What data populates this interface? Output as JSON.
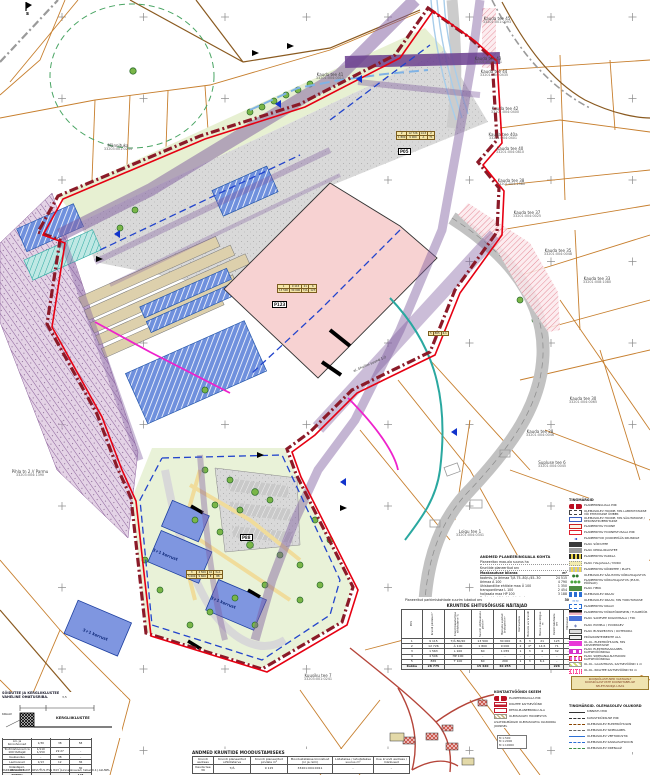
{
  "north_mark": "s",
  "colors": {
    "boundary_red": "#e60012",
    "boundary_dark": "#8b1a28",
    "plot_pink": "#f7d2d2",
    "building_blue": "#5b82d8",
    "corridor_purple": "#7d5a9e",
    "greenery": "#e9f2d8",
    "cadastral_orange": "#c77f2e"
  },
  "map": {
    "parcels": [
      {
        "name": "Kauda tee 45",
        "code": "33201:001:0093"
      },
      {
        "name": "Kauda tee 43",
        "code": "33201:001:0071"
      },
      {
        "name": "Kauda tee 44",
        "code": "33201:004:0435"
      },
      {
        "name": "Kauda tee 42",
        "code": "33201:004:0400"
      },
      {
        "name": "Kauda tee 40a",
        "code": "33201:004:0401"
      },
      {
        "name": "Kauda tee 40",
        "code": "33201:004:0810"
      },
      {
        "name": "Kauda tee 38",
        "code": "33201:004:1580"
      },
      {
        "name": "Kauda tee 37",
        "code": "33201:004:0025"
      },
      {
        "name": "Kauda tee 35",
        "code": "33201:004:0048"
      },
      {
        "name": "Kauda tee 33",
        "code": "33201:008:1080"
      },
      {
        "name": "Kauda tee 30",
        "code": "33201:004:0065"
      },
      {
        "name": "Kauda tee 28",
        "code": "33201:004:0046"
      },
      {
        "name": "Supluse tee 6",
        "code": "33201:004:0045"
      },
      {
        "name": "Pihla tn 2 // Parmu",
        "code": "33203:004:1390"
      },
      {
        "name": "Männituka",
        "code": "33203:001:0244"
      },
      {
        "name": "Kuusiku tee 7",
        "code": "33203:001:0241"
      },
      {
        "name": "Loigu tee 1",
        "code": "33201:004:0341"
      },
      {
        "name": "Kauda tee 41",
        "code": "33201:004:0011"
      }
    ],
    "building_labels": [
      "3+1 korrust",
      "3+1 korrust",
      "3+1 korrust"
    ],
    "pos_labels": [
      "P123",
      "P05",
      "P88"
    ],
    "line_label": "el. õhuliini suund 1:2",
    "mini_tables": {
      "t1": [
        [
          "1",
          "9 115",
          "21",
          "6"
        ],
        [
          "13 500",
          "30 000",
          "T/Ä",
          "123"
        ]
      ],
      "t2": [
        [
          "2",
          "12 726",
          "14,5",
          "2"
        ],
        [
          "1 800",
          "9 000",
          "Ä",
          "71"
        ]
      ],
      "t3": [
        [
          "3",
          "4 506",
          "10",
          "3+1"
        ],
        [
          "5 600",
          "9 600",
          "E",
          "88"
        ]
      ],
      "t4": [
        [
          "5",
          "865",
          "6,1"
        ]
      ]
    }
  },
  "summary": {
    "title": "ANDMED PLANEERINGUALA KOHTA",
    "rows": [
      {
        "label": "Planeeritav maa-ala suurus ha",
        "value": "3,2"
      },
      {
        "label": "Kruntide planeeritud arv",
        "value": "5"
      }
    ],
    "usage_header": {
      "label": "Maakasutuse bilanss",
      "col1": "m²",
      "col2": "%"
    },
    "usage_rows": [
      {
        "label": "tootmis- ja ärimaa T/Ä 75..80/–/45..30",
        "area": "24 515",
        "pct": "67"
      },
      {
        "label": "ärimaa Ä 100",
        "area": "4 790",
        "pct": "13"
      },
      {
        "label": "ühiskondlike ehitiste maa Ü 100",
        "area": "1 350",
        "pct": "4"
      },
      {
        "label": "transpordimaa L 100",
        "area": "2 454",
        "pct": "7"
      },
      {
        "label": "haljasala maa HP 100",
        "area": "3 188",
        "pct": "9"
      }
    ],
    "note": {
      "label": "Parkimiskohti kokku lubatud arv",
      "value": "30"
    }
  },
  "build_rights_table": {
    "note": {
      "label": "Planeeritud parkimiskohtade suurim lubatud arv",
      "value": "30"
    },
    "title": "KRUNTIDE EHITUSÕIGUSE NÄITAJAD",
    "columns": [
      "POS",
      "Krundi pindala m²",
      "Krundi kasutamise sihtotstarve %",
      "Suurim ehitisealune pind m²",
      "Hoonete suletud brutopind m²",
      "Korruselisus",
      "Hoonete arv krundil",
      "Hoone max kõrgus m",
      "Parkimiskohtade arv",
      "Märkused"
    ],
    "rows": [
      [
        "1",
        "9 115",
        "T/Ä 80/20",
        "13 500",
        "30 000",
        "6",
        "3",
        "21",
        "123",
        "–"
      ],
      [
        "2",
        "12 726",
        "Ä 100",
        "1 800",
        "9 000",
        "2",
        "4*",
        "14,5",
        "71",
        "–"
      ],
      [
        "3",
        "1 563",
        "L 100",
        "60",
        "1 055",
        "1",
        "3",
        "4",
        "32",
        "–"
      ],
      [
        "4",
        "4 506",
        "HP 100",
        "–",
        "–",
        "–",
        "–",
        "–",
        "–",
        "–"
      ],
      [
        "5",
        "865",
        "T 100",
        "60",
        "200",
        "1",
        "3",
        "6,1",
        "–",
        "–"
      ]
    ],
    "total": [
      "Kokku",
      "28 775",
      "",
      "15 420",
      "40 255",
      "",
      "",
      "",
      "226",
      ""
    ]
  },
  "parking_table": {
    "title": "PARKIMISKOHTADE ARVUTUS (EVS 843)",
    "columns": [
      "Kasutusotstarve",
      "parkimis- normatiiv",
      "arvutuslik kohtade arv",
      "planeeritud kohtade arv"
    ],
    "rows": [
      [
        "Äri- ja büroohooned",
        "1/30",
        "38",
        "58"
      ],
      [
        "Tootmishooned ca 100 töötajat",
        "1/110  1/150",
        "29  27",
        "–"
      ],
      [
        "Kaubandus",
        "–",
        "38",
        "–"
      ],
      [
        "Laohooned",
        "1/13",
        "12",
        "36"
      ],
      [
        "Külastajad, abiruumid",
        "–",
        "–",
        "30"
      ]
    ],
    "total": [
      "KOKKU",
      "",
      "",
      "124"
    ],
    "note": "PARKIMISKOHTADE ARVUTUS EVS 843 (Linnatänavad, tabel 9.1) ALUSEL"
  },
  "formation_table": {
    "title": "ANDMED KRUNTIDE MOODUSTAMISEKS",
    "columns": [
      "Krundi aadress",
      "Krundi planeeritud sihtotstarve",
      "Krundi planeeritud pindala m²",
      "Moodustatakse kinnistust (nr ja nimi)",
      "Liidetakse / lahutatakse suurus m²",
      "Uue krundi aadress / märkused"
    ],
    "rows": [
      [
        "Kauda tee 39",
        "T/Ä",
        "9 115",
        "33201:004:0011",
        "–",
        "–"
      ]
    ]
  },
  "section": {
    "note_line1": "SÕIDUTEE JA KERGLIIKLUSTEE",
    "note_line2": "VAHELINE OHUTUSRIBA.",
    "dims": [
      "2,5",
      "3,5"
    ],
    "label": "KERGLIIKLUSTEE",
    "left_label": "KRAAV"
  },
  "legend": {
    "title": "TINGMÄRGID",
    "items": [
      {
        "sym": "logo",
        "label": "PLANEERINGUALA PIIR"
      },
      {
        "sym": "bld-old",
        "label": "OLEMASOLEV HOONE, MIS LAMMUTATAKSE VÕI EHITATAKSE ÜMBER"
      },
      {
        "sym": "bld-keep",
        "label": "OLEMASOLEV HOONE, MIS SÄILITATAKSE / REKONSTRUEERITAKSE"
      },
      {
        "sym": "bld-new",
        "label": "PLANEERITAV HOONE"
      },
      {
        "sym": "hoonestus",
        "label": "PLANEERITAV HOONESTUSALA PIIR"
      },
      {
        "sym": "glyph",
        "glyph": "◄",
        "color": "#1133cc",
        "label": "PLANEERITUD JUURDEPÄÄS KRUNDILE"
      },
      {
        "sym": "asphalt",
        "label": "PLAN. SÕIDUTEE"
      },
      {
        "sym": "kergtee",
        "label": "PLAN. KERGLIIKLUSTEE"
      },
      {
        "sym": "parkla",
        "label": "PLANEERITAV PARKLA"
      },
      {
        "sym": "haljas",
        "label": "PLAN. HALJASALA / MURU"
      },
      {
        "sym": "striped",
        "label": "PLANEERITAV KÕNNITEE / PLATS"
      },
      {
        "sym": "glyph",
        "glyph": "●●",
        "color": "#2d7a2d",
        "label": "OLEMASOLEV SÄILITATAV KÕRGHALJASTUS"
      },
      {
        "sym": "glyph",
        "glyph": "●●●",
        "color": "#49a33c",
        "label": "PLANEERITAV KÕRGHALJASTUS (PUUD, PÕÕSAD)"
      },
      {
        "sym": "hedge",
        "label": "PLAN. HEKK"
      },
      {
        "sym": "ditch",
        "label": "OLEMASOLEV KRAAV"
      },
      {
        "sym": "glyph",
        "glyph": "≈≈",
        "color": "#2b6fd4",
        "label": "OLEMASOLEV KRAAV, MIS TORUTATAKSE"
      },
      {
        "sym": "newditch",
        "label": "PLANEERITAV KRAAV"
      },
      {
        "sym": "noise",
        "label": "PLANEERITAV MÜRATÕKKESEIN / TUGIMÜÜR"
      },
      {
        "sym": "water",
        "label": "PLAN. SADEVEE KOGUMISALA / TIIK"
      },
      {
        "sym": "glyph",
        "glyph": "◈",
        "color": "#5566aa",
        "label": "PLAN. PUMPLA / PUURKAEV"
      },
      {
        "sym": "bus",
        "label": "PLAN. BUSSIPEATUS / OOTEKODA"
      },
      {
        "sym": "waste",
        "label": "PRÜGIKONTEINERITE ALA"
      },
      {
        "sym": "el",
        "label": "OL.OL. ELEKTRIÕHULIIN, MIS LIKVIDEERITAKSE"
      },
      {
        "sym": "side",
        "label": "PLAN. ELEKTRIMAAKAABEL KAITSEVÖÖNDIGA"
      },
      {
        "sym": "el-dash",
        "label": "PLAN. SIDEKANALISATSIOON KAITSEVÖÖNDIGA"
      },
      {
        "sym": "gaas",
        "label": "OL.OL. GAASITRASS, KAITSEVÖÖND 1 m"
      },
      {
        "sym": "teekv",
        "label": "OL.OL. RIIGITEE KAITSEVÖÖND 50 m"
      }
    ]
  },
  "stamp": {
    "lines": [
      "KOOSKÕLASTUSED VASTAVALT",
      "KOOSKÕLASTUSTE KOONDTABELILE",
      "SELETUSKIRJA LISAS"
    ]
  },
  "legend_existing": {
    "title": "TINGMÄRGID. OLEMASOLEV OLUKORD",
    "items": [
      {
        "line": "solid",
        "label": "KINNISTU PIIR"
      },
      {
        "line": "dash",
        "label": "KATASTRIÜKSUSE PIIR"
      },
      {
        "line": "dashdot",
        "label": "OLEMASOLEV ELEKTRIÕHULIIN"
      },
      {
        "line": "dash2",
        "label": "OLEMASOLEV SIDEKAABEL"
      },
      {
        "line": "solid2",
        "label": "OLEMASOLEV VEETORUSTIK"
      },
      {
        "line": "dashdot2",
        "label": "OLEMASOLEV KANALISATSIOON"
      },
      {
        "line": "dash3",
        "label": "OLEMASOLEV DRENAAŽ"
      }
    ]
  },
  "mini_legend": {
    "title": "KONTAKTVÖÖNDI SKEEM",
    "items": [
      {
        "sym": "logo",
        "label": "PLANEERINGUALA PIIR"
      },
      {
        "sym": "redstripe",
        "label": "RIIGITEE KAITSEVÖÖND"
      },
      {
        "sym": "redbox",
        "label": "DETAILPLANEERINGU ALA"
      },
      {
        "sym": "tanhatch",
        "label": "OLEMASOLEV HOONESTUS"
      }
    ],
    "note": "LISATINGMÄRGID OLEMASOLEVA OLUKORRA JOONISEL",
    "scale_rows": [
      "M 1:500",
      "M 1:2000",
      "M 1:10000"
    ]
  }
}
